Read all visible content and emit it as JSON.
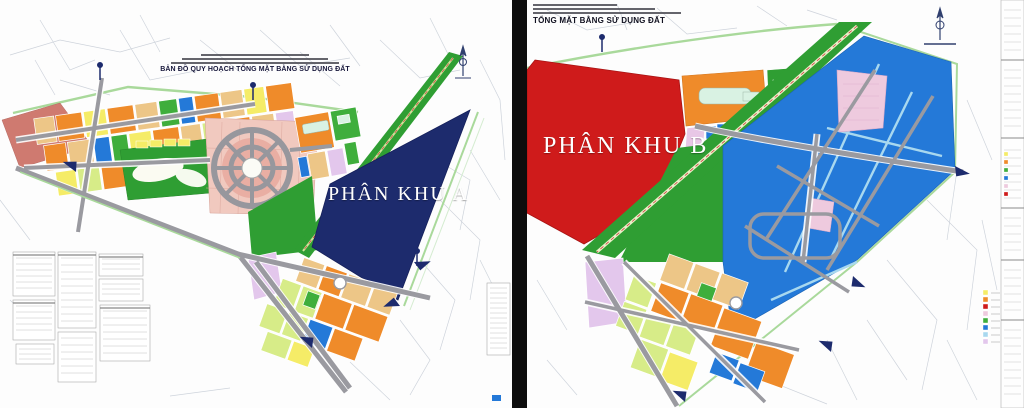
{
  "left_map": {
    "title": "BẢN ĐỒ QUY HOẠCH TỔNG MẶT BẰNG SỬ DỤNG ĐẤT",
    "zone_label": "PHÂN KHU A",
    "zone_fill": "#1d2b6d"
  },
  "right_map": {
    "title": "TỔNG MẶT BẰNG SỬ DỤNG ĐẤT",
    "zone_label": "PHÂN KHU B",
    "zone_fill": "#cf1b1b"
  },
  "palette": {
    "background": "#fdfdfd",
    "divider": "#0d0d0d",
    "zone_a_navy": "#1d2b6d",
    "zone_b_red": "#cf1b1b",
    "parcel_orange": "#ef8b2a",
    "parcel_yellow": "#f5ec67",
    "parcel_lime": "#d7ec88",
    "parcel_green": "#3fae3c",
    "strip_green": "#2f9e33",
    "parcel_blue": "#2479d8",
    "canal_light_blue": "#a8d8ef",
    "district_pink": "#f1c9bf",
    "ring_pink": "#e9aea3",
    "parcel_lavender": "#e3c7ec",
    "patch_pink": "#eecade",
    "parcel_salmon": "#cf7a70",
    "parcel_tan": "#edc687",
    "building_mint": "#d9f2e3",
    "road_grey": "#9a9aa0",
    "boundary_green": "#a9d99b",
    "title_ink": "#16163a"
  }
}
